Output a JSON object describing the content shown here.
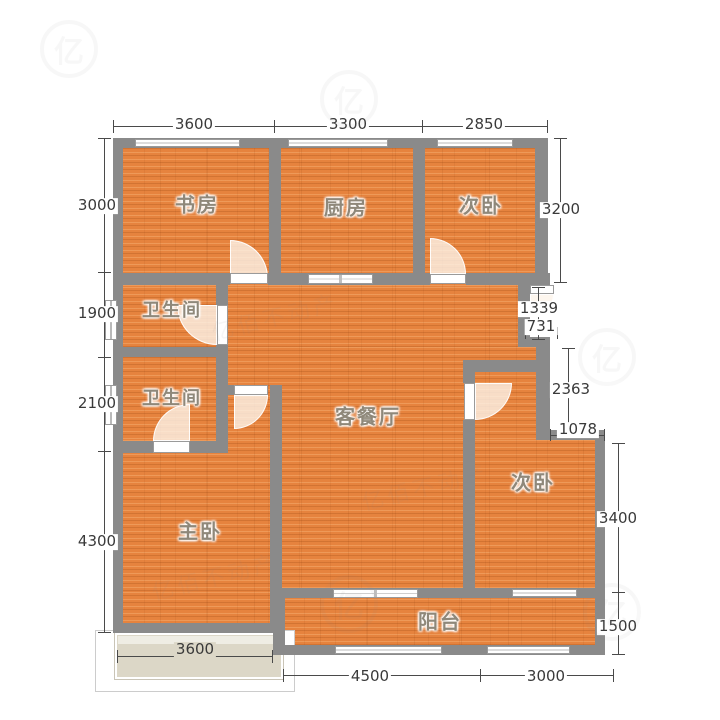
{
  "plan": {
    "type": "residential-floor-plan"
  },
  "rooms": {
    "study": "书房",
    "kitchen": "厨房",
    "bedroom_top": "次卧",
    "bathroom_1": "卫生间",
    "bathroom_2": "卫生间",
    "living_dining": "客餐厅",
    "master_bedroom": "主卧",
    "bedroom_right": "次卧",
    "balcony": "阳台"
  },
  "dimensions": {
    "top": [
      "3600",
      "3300",
      "2850"
    ],
    "left": [
      "3000",
      "1900",
      "2100",
      "4300"
    ],
    "right": [
      "3200",
      "1339",
      "731",
      "2363",
      "1078",
      "3400",
      "1500"
    ],
    "bottom_bay": "3600",
    "bottom": [
      "4500",
      "3000"
    ]
  },
  "watermark": {
    "logo_char": "亿",
    "text": "亿佰不动产"
  },
  "colors": {
    "wall": "#8a8a8a",
    "floor": "#e6833e",
    "bay_fill": "#dcd7c7",
    "dim_text": "#3a3a3a",
    "room_text": "#8f887a"
  }
}
